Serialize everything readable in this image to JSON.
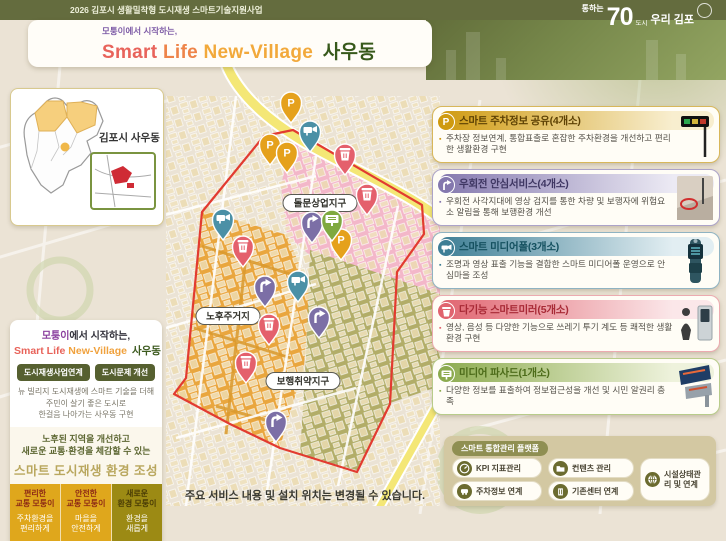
{
  "header": {
    "program": "2026 김포시 생활밀착형 도시재생 스마트기술지원사업",
    "logo_small": "통하는",
    "logo_big": "70",
    "logo_tiny": "도시",
    "logo_rest": "우리 김포",
    "pre_title": "모퉁이에서 시작하는,",
    "title_part1": "Smart",
    "title_part2": "Life",
    "title_part3": "New-Village",
    "title_part4": "사우동"
  },
  "gimpo_map": {
    "label": "김포시 사우동"
  },
  "site_map": {
    "labels": [
      {
        "text": "돌문상업지구",
        "x": 154,
        "y": 137
      },
      {
        "text": "노후주거지",
        "x": 62,
        "y": 250
      },
      {
        "text": "보행취약지구",
        "x": 137,
        "y": 315
      }
    ],
    "pins": [
      {
        "type": "parking",
        "x": 125,
        "y": 57
      },
      {
        "type": "parking",
        "x": 104,
        "y": 99
      },
      {
        "type": "parking",
        "x": 121,
        "y": 107
      },
      {
        "type": "parking",
        "x": 175,
        "y": 194
      },
      {
        "type": "mediapole",
        "x": 144,
        "y": 86
      },
      {
        "type": "mediapole",
        "x": 57,
        "y": 174
      },
      {
        "type": "mediapole",
        "x": 132,
        "y": 236
      },
      {
        "type": "mirror",
        "x": 179,
        "y": 109
      },
      {
        "type": "mirror",
        "x": 201,
        "y": 149
      },
      {
        "type": "mirror",
        "x": 77,
        "y": 201
      },
      {
        "type": "mirror",
        "x": 103,
        "y": 279
      },
      {
        "type": "mirror",
        "x": 80,
        "y": 317
      },
      {
        "type": "rightturn",
        "x": 146,
        "y": 177
      },
      {
        "type": "rightturn",
        "x": 99,
        "y": 241
      },
      {
        "type": "rightturn",
        "x": 153,
        "y": 272
      },
      {
        "type": "rightturn",
        "x": 110,
        "y": 376
      },
      {
        "type": "facade",
        "x": 166,
        "y": 175
      }
    ]
  },
  "services": [
    {
      "title": "스마트 주차정보 공유(4개소)",
      "desc": "주차장 정보연계, 통합표출로 혼잡한 주차환경을 개선하고 편리한 생활환경 구현"
    },
    {
      "title": "우회전 안심서비스(4개소)",
      "desc": "우회전 사각지대에 영상 검지를 통한 차량 및 보행자에 위험요소 알림을 통해 보행환경 개선"
    },
    {
      "title": "스마트 미디어폴(3개소)",
      "desc": "조명과 영상 표출 기능을 결합한 스마트 미디어폴 운영으로 안심마을 조성"
    },
    {
      "title": "다기능 스마트미러(5개소)",
      "desc": "영상, 음성 등 다양한 기능으로 쓰레기 투기 계도 등 쾌적한 생활 환경 구현"
    },
    {
      "title": "미디어 파사드(1개소)",
      "desc": "다양한 정보를 표출하여 정보접근성을 개선 및 시민 알권리 충족"
    }
  ],
  "platform": {
    "label": "스마트 통합관리 플랫폼",
    "items": [
      {
        "label": "KPI 지표관리",
        "icon": "gauge-icon"
      },
      {
        "label": "컨텐츠 관리",
        "icon": "folder-icon"
      },
      {
        "label": "주차정보 연계",
        "icon": "car-icon"
      },
      {
        "label": "기존센터 연계",
        "icon": "building-icon"
      },
      {
        "label": "시설상태관리 및 연계",
        "icon": "globe-icon"
      }
    ]
  },
  "left_info": {
    "pre_accent": "모퉁이",
    "pre_rest": "에서 시작하는,",
    "title_red": "Smart Life",
    "title_orange": "New-Village",
    "title_green": "사우동",
    "buttons": [
      "도시재생사업연계",
      "도시문제 개선"
    ],
    "para": [
      "뉴 빌리지 도시재생에 스마트 기술을 더해",
      "주민이 살기 좋은 도시로",
      "한걸음 나아가는 사우동 구현"
    ],
    "highlight": [
      "노후된 지역을 개선하고",
      "새로운 교통·환경을 체감할 수 있는"
    ],
    "highlight_big": "스마트 도시재생 환경 조성",
    "columns": [
      {
        "head1": "편리한",
        "head2": "교통 모퉁이",
        "body1": "주차환경을",
        "body2": "편리하게"
      },
      {
        "head1": "안전한",
        "head2": "교통 모퉁이",
        "body1": "마을을",
        "body2": "안전하게"
      },
      {
        "head1": "새로운",
        "head2": "환경 모퉁이",
        "body1": "환경을",
        "body2": "새롭게"
      }
    ]
  },
  "footnote": "주요 서비스 내용 및 설치 위치는 변경될 수 있습니다.",
  "colors": {
    "pin_parking": "#e5a11c",
    "pin_rightturn": "#7c6fa6",
    "pin_mediapole": "#4b90a6",
    "pin_mirror": "#e4606c",
    "pin_facade": "#7fa93f",
    "zone_pink": "#f3b7c9",
    "zone_orange": "#e9a63e",
    "zone_olive": "#b2ad68",
    "boundary_red": "#e23b30",
    "accent_gold": "#cf9a10",
    "accent_purple": "#8478ae",
    "accent_teal": "#3e7e95",
    "accent_red": "#e0646f",
    "accent_green": "#8cab4e"
  }
}
